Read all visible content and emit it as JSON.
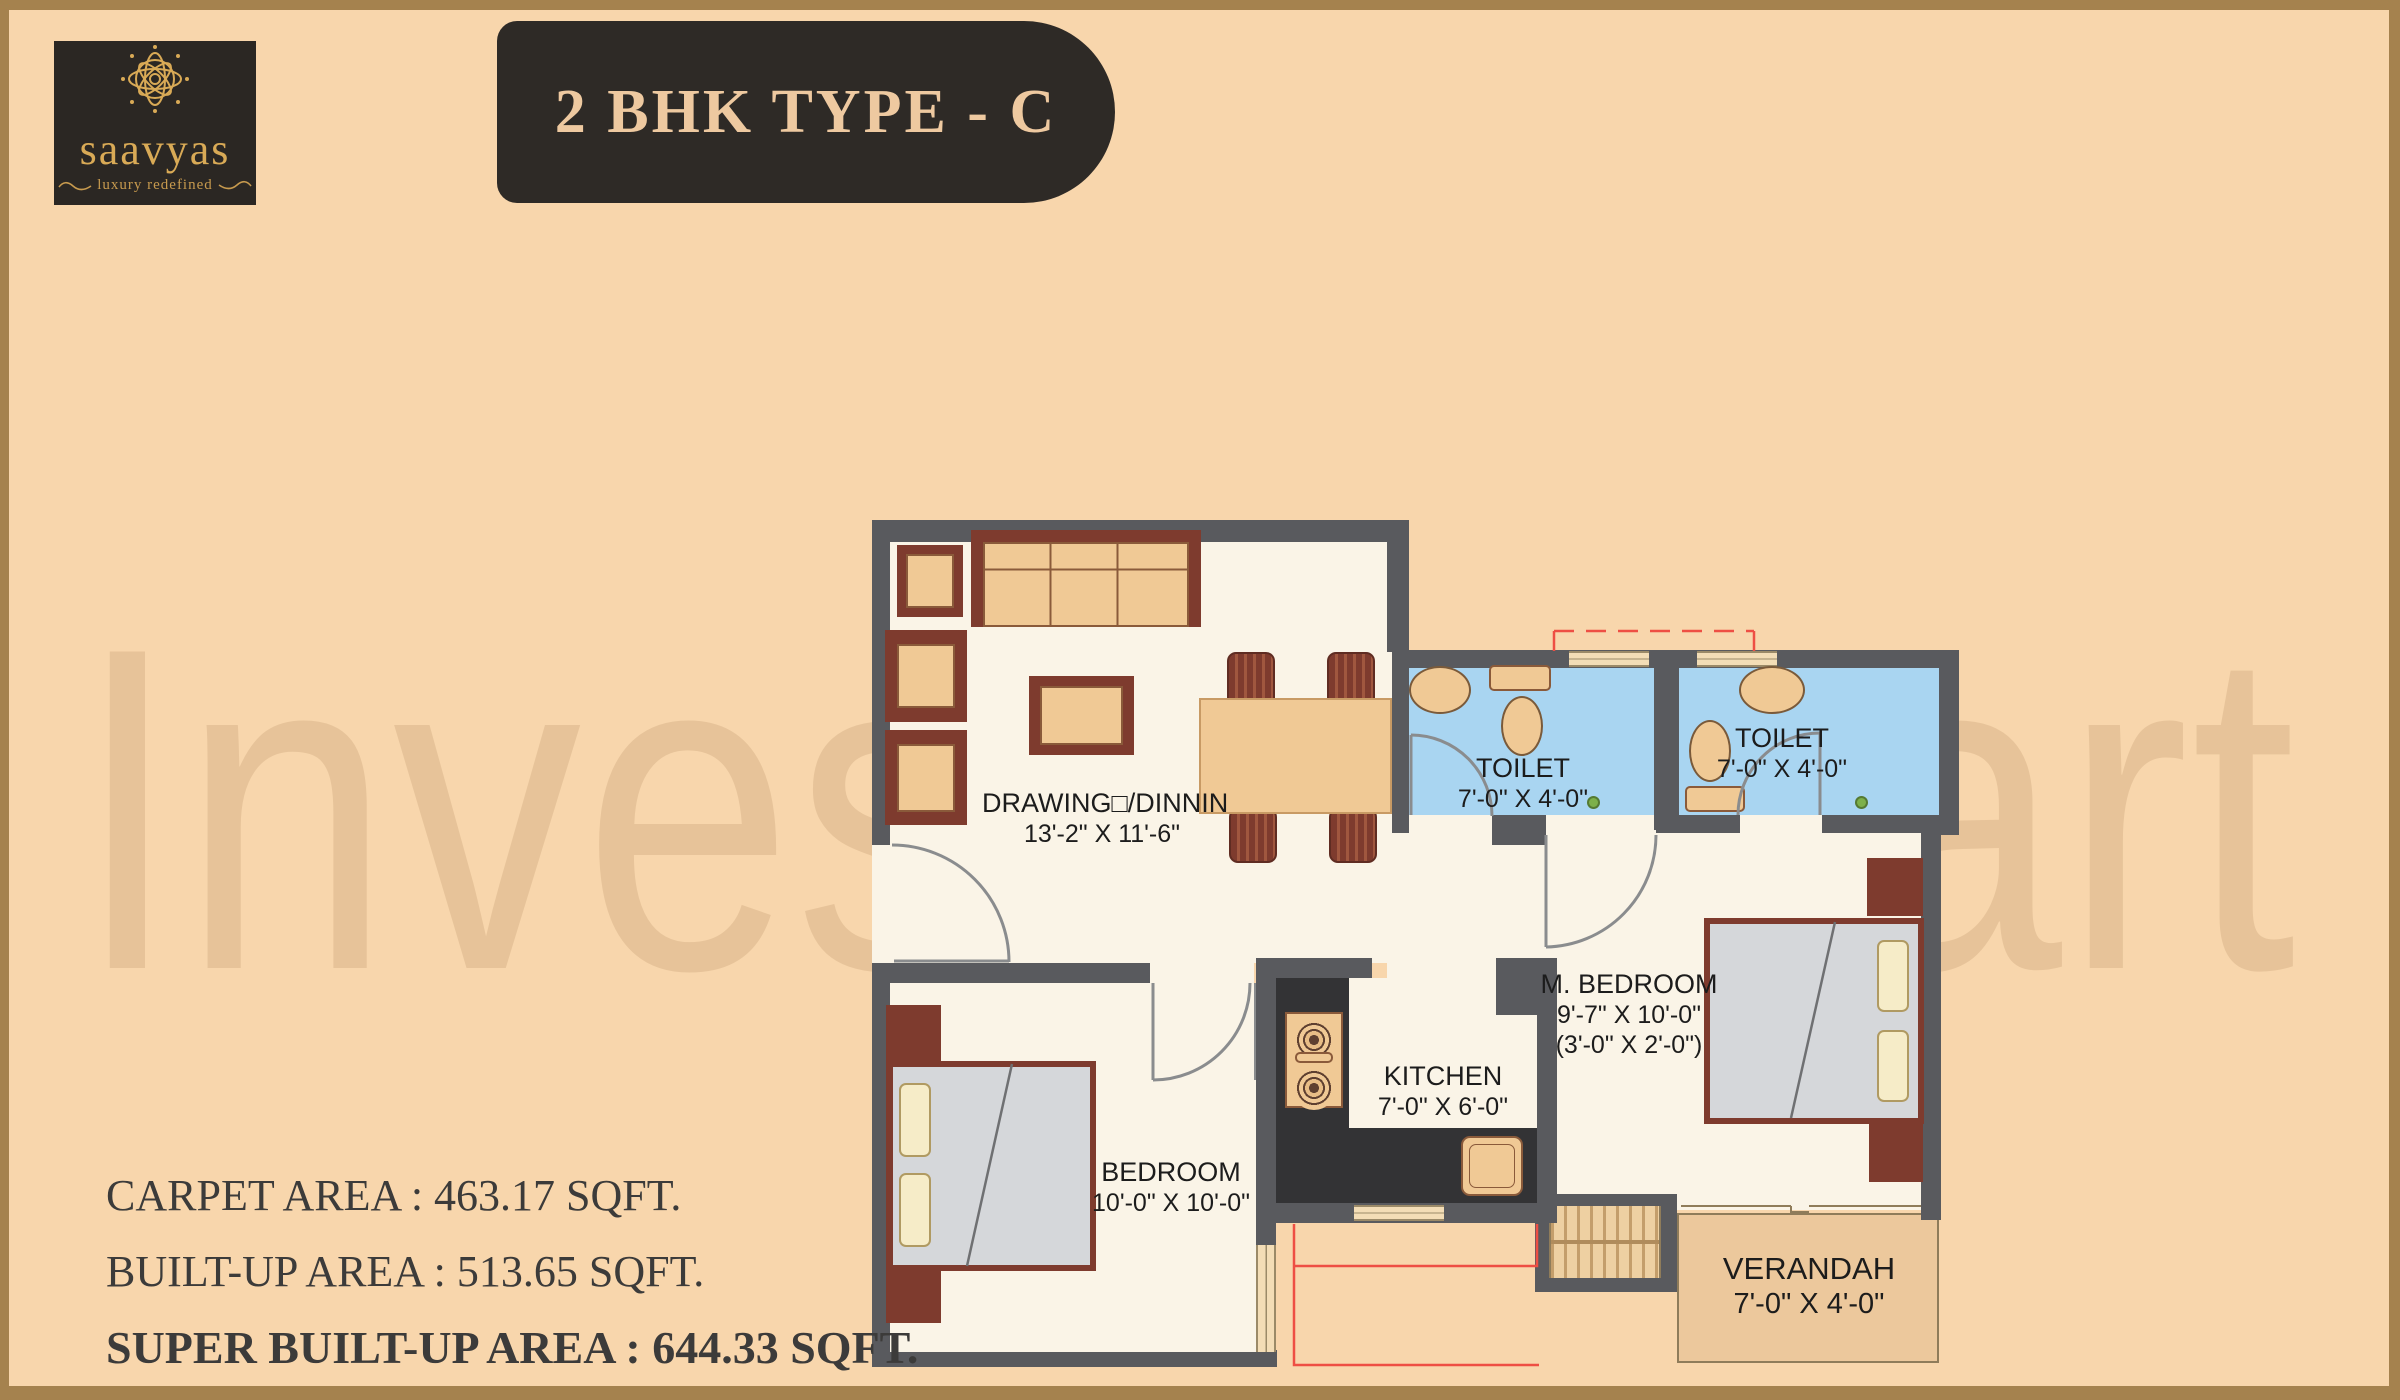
{
  "logo": {
    "brand": "saavyas",
    "tagline": "luxury redefined",
    "box_color": "#2b2723",
    "gold": "#d9aa56",
    "flower_icon": "lotus-mandala-icon"
  },
  "banner": {
    "title": "2 BHK TYPE - C",
    "bg": "#2e2a26",
    "text_color": "#eec9a0"
  },
  "watermark": {
    "text": "Investor Mart"
  },
  "areas": {
    "carpet": "CARPET AREA : 463.17 SQFT.",
    "built_up": "BUILT-UP AREA : 513.65 SQFT.",
    "super_built_up": "SUPER BUILT-UP AREA : 644.33 SQFT."
  },
  "floorplan": {
    "colors": {
      "wall": "#595a5e",
      "floor": "#faf4e7",
      "toilet_floor": "#a9d5f1",
      "verandah_floor": "#ecc89c",
      "furniture_tan": "#f0c995",
      "furniture_maroon": "#7e3b2e",
      "counter": "#333335",
      "red_line": "#ee4f44",
      "background": "#f8d6ac",
      "frame": "#a5824e"
    },
    "rooms": {
      "drawing": {
        "name": "DRAWING□/DINNIN",
        "dims": "13'-2\" X 11'-6\""
      },
      "toilet1": {
        "name": "TOILET",
        "dims": "7'-0\" X 4'-0\""
      },
      "toilet2": {
        "name": "TOILET",
        "dims": "7'-0\" X 4'-0\""
      },
      "mbedroom": {
        "name": "M. BEDROOM",
        "dims": "9'-7\" X 10'-0\"",
        "dims2": "(3'-0\" X 2'-0\")"
      },
      "kitchen": {
        "name": "KITCHEN",
        "dims": "7'-0\" X 6'-0\""
      },
      "bedroom": {
        "name": "BEDROOM",
        "dims": "10'-0\" X 10'-0\""
      },
      "verandah": {
        "name": "VERANDAH",
        "dims": "7'-0\" X 4'-0\""
      }
    }
  }
}
